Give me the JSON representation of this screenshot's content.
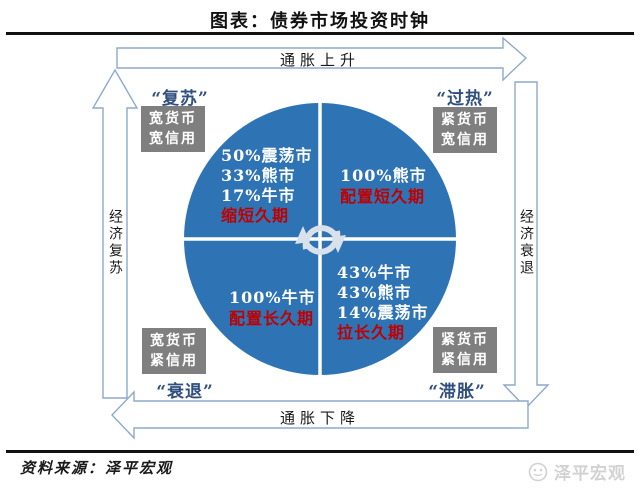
{
  "title": "图表：债券市场投资时钟",
  "axes": {
    "top": "通胀上升",
    "bottom": "通胀下降",
    "left": "经济复苏",
    "right": "经济衰退"
  },
  "quadrants": {
    "top_left": {
      "corner_label": "“复苏”",
      "policy": [
        "宽货币",
        "宽信用"
      ],
      "stats": [
        "50%震荡市",
        "33%熊市",
        "17%牛市"
      ],
      "strategy": "缩短久期"
    },
    "top_right": {
      "corner_label": "“过热”",
      "policy": [
        "紧货币",
        "宽信用"
      ],
      "stats": [
        "100%熊市"
      ],
      "strategy": "配置短久期"
    },
    "bottom_left": {
      "corner_label": "“衰退”",
      "policy": [
        "宽货币",
        "紧信用"
      ],
      "stats": [
        "100%牛市"
      ],
      "strategy": "配置长久期"
    },
    "bottom_right": {
      "corner_label": "“滞胀”",
      "policy": [
        "紧货币",
        "紧信用"
      ],
      "stats": [
        "43%牛市",
        "43%熊市",
        "14%震荡市"
      ],
      "strategy": "拉长久期"
    }
  },
  "colors": {
    "circle_blue": "#2E74B5",
    "strategy_red": "#C00000",
    "policy_box_gray": "#7F7F7F",
    "arrow_outline_blue": "#8FA9CC",
    "corner_label_navy": "#2F4F7F",
    "watermark_gray": "#D2D2D2"
  },
  "footer": {
    "source": "资料来源：泽平宏观",
    "watermark": "泽平宏观"
  }
}
